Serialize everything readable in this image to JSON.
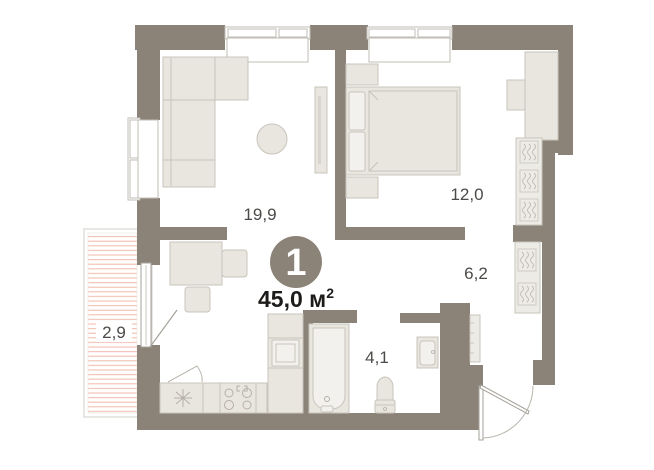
{
  "unit": {
    "number": "1",
    "area_label": "45,0 м",
    "area_sup": "2",
    "area_full": "45,0 м²"
  },
  "rooms": {
    "living": {
      "label": "19,9"
    },
    "bedroom": {
      "label": "12,0"
    },
    "hall": {
      "label": "6,2"
    },
    "bath": {
      "label": "4,1"
    },
    "balcony": {
      "label": "2,9"
    }
  },
  "icons": {
    "wardrobe_hanger": "zigzag-hanger-rail",
    "kitchen_sink": "asterisk-star",
    "entrance_door": "quarter-arc-swing",
    "balcony_hatch": "horizontal-pink-lines"
  },
  "colors": {
    "wall": "#8c8378",
    "floor": "#ffffff",
    "furniture_fill": "#e9e6e0",
    "furniture_stroke": "#c8c4bb",
    "balcony_hatch": "#f2bfb1",
    "room_label_text": "#4c4a47",
    "area_text": "#1e1c1a",
    "badge_fill": "#8c8378",
    "badge_text": "#ffffff"
  }
}
